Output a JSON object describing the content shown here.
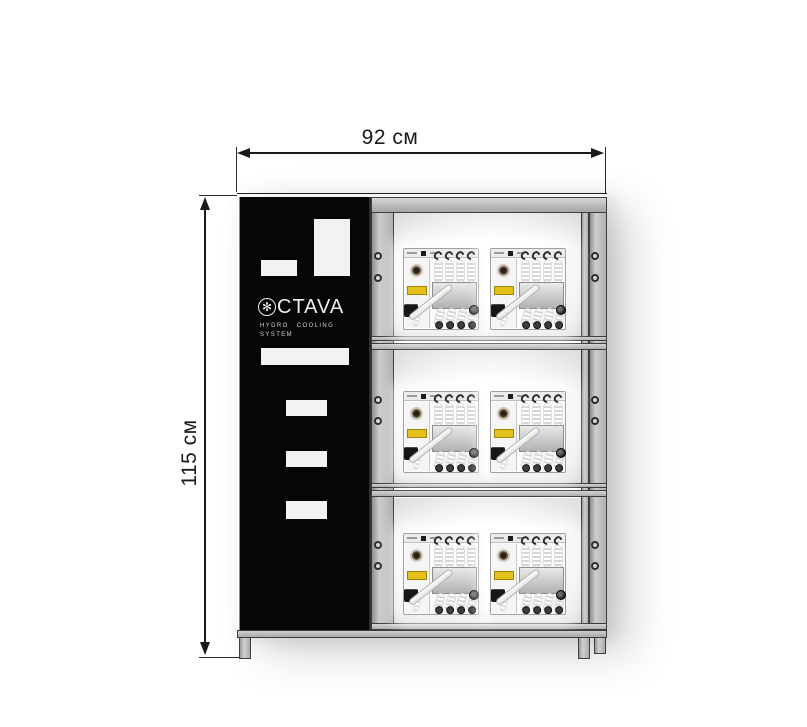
{
  "dimensions": {
    "width_label": "92 см",
    "height_label": "115 см"
  },
  "brand_panel": {
    "logo_icon": "snowflake-icon",
    "logo_icon_glyph": "✻",
    "logo_text": "CTAVA",
    "tagline_line1": "HYDRO COOLING",
    "tagline_line2": "SYSTEM"
  },
  "rack": {
    "shelf_count": 3,
    "machines_per_shelf": 2,
    "machine_type": "hydro cooling unit with coiled hoses"
  },
  "colors": {
    "ink": "#1a1a1a",
    "panel-black": "#060606",
    "frame-gray": "#b5b5b5",
    "accent-yellow": "#e3c01a"
  }
}
